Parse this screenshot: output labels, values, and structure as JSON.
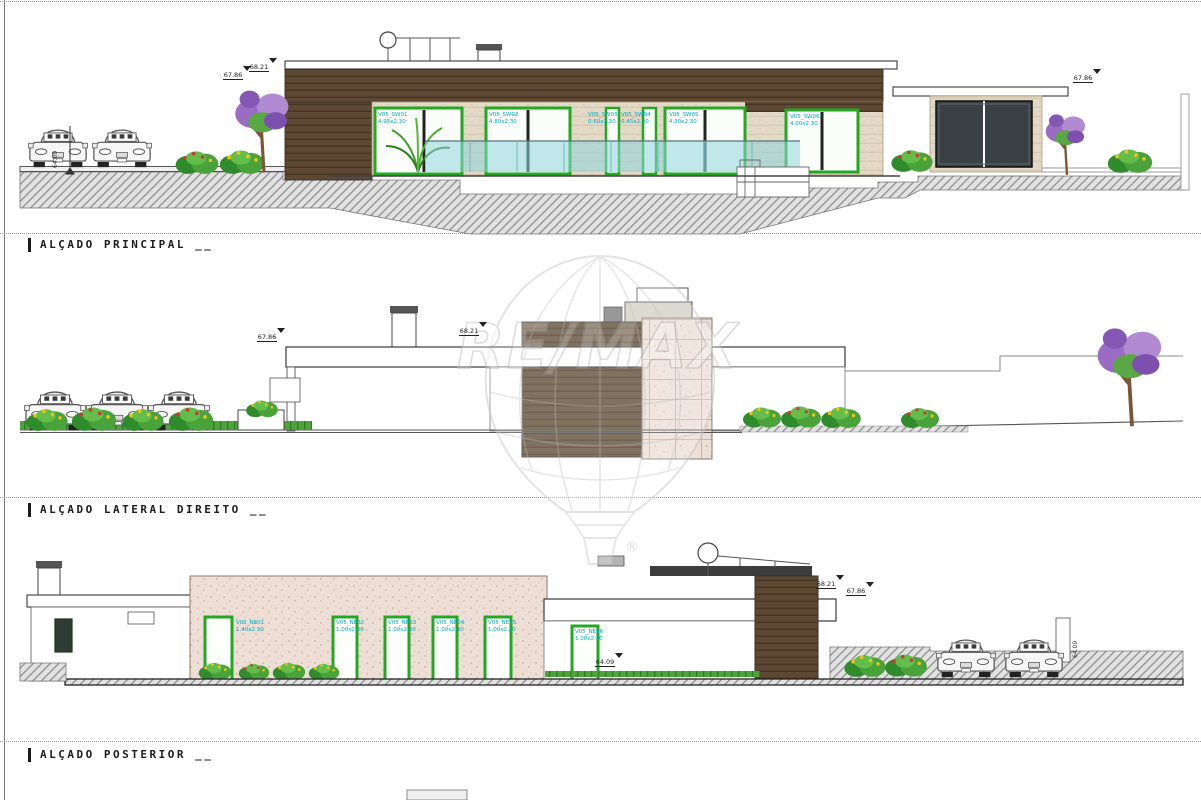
{
  "palette": {
    "wood": "#5d4833",
    "stone": "#ecdfd6",
    "travertine": "#e3d9c6",
    "glass_pool": "#8fd6dc",
    "window_frame_green": "#22a822",
    "label_cyan": "#00a9c4",
    "ground_hatch": "#9a9a9a",
    "ink": "#1a1a1a",
    "grass": "#4da23c",
    "watermark_gray": "#c9c9c9"
  },
  "watermark": {
    "brand": "RE/MAX",
    "registered": "®"
  },
  "sections": {
    "principal": {
      "label": "ALÇADO PRINCIPAL __"
    },
    "lateral": {
      "label": "ALÇADO LATERAL DIREITO __"
    },
    "posterior": {
      "label": "ALÇADO POSTERIOR __"
    }
  },
  "principal": {
    "windows": [
      {
        "name": "V05_SW01",
        "dim": "4.95x2.30"
      },
      {
        "name": "V05_SW02",
        "dim": "4.80x2.30"
      },
      {
        "name": "V05_SW03",
        "dim": "0.60x2.30"
      },
      {
        "name": "V05_SW04",
        "dim": "0.45x2.30"
      },
      {
        "name": "V05_SW05",
        "dim": "4.30x2.30"
      },
      {
        "name": "V05_SW06",
        "dim": "4.00x2.30"
      }
    ],
    "markers": [
      "67.86",
      "68.21",
      "67.86"
    ],
    "level_left": "64.09"
  },
  "lateral": {
    "markers": [
      "67.86",
      "68.21"
    ]
  },
  "posterior": {
    "doors": [
      {
        "name": "V05_NE01",
        "dim": "1.40x2.30"
      },
      {
        "name": "V05_NE02",
        "dim": "1.00x2.30"
      },
      {
        "name": "V05_NE03",
        "dim": "1.00x2.30"
      },
      {
        "name": "V05_NE04",
        "dim": "1.00x2.30"
      },
      {
        "name": "V05_NE05",
        "dim": "1.00x2.30"
      },
      {
        "name": "V05_NE06",
        "dim": "1.00x2.30"
      }
    ],
    "markers": [
      "68.21",
      "67.86",
      "64.09"
    ],
    "level_right": "64.09"
  }
}
